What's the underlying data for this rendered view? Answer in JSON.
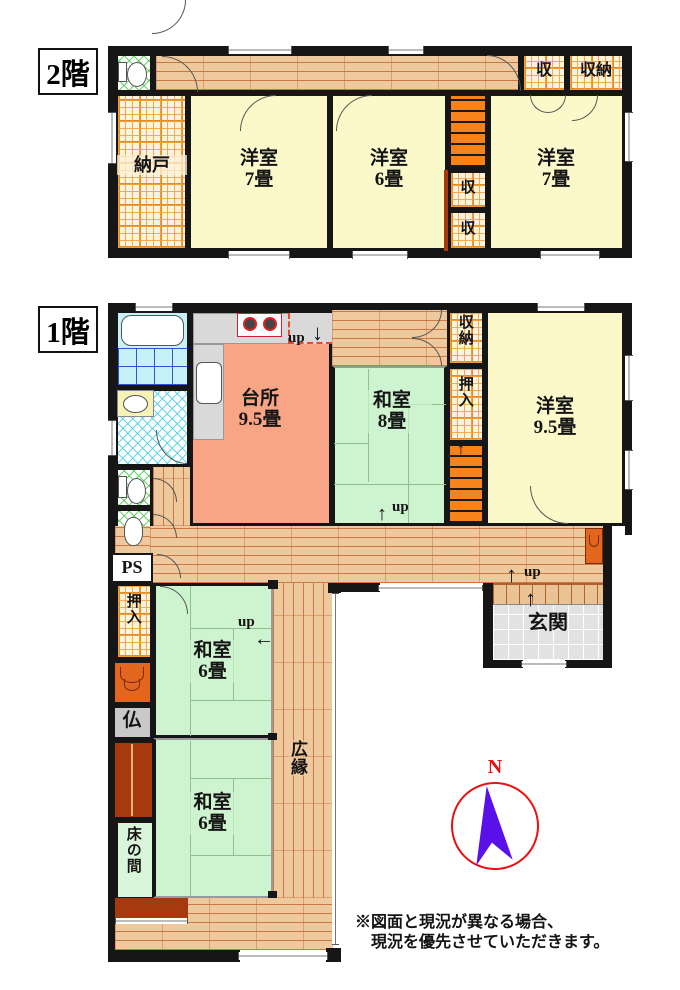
{
  "floor2": {
    "label": "2階",
    "nando": "納戸",
    "yoshitsu7a": {
      "name": "洋室",
      "size": "7畳"
    },
    "yoshitsu6": {
      "name": "洋室",
      "size": "6畳"
    },
    "yoshitsu7b": {
      "name": "洋室",
      "size": "7畳"
    },
    "closet_top1": "収",
    "closet_top2": "収納",
    "closet_mid1": "収",
    "closet_mid2": "収"
  },
  "floor1": {
    "label": "1階",
    "daidokoro": {
      "name": "台所",
      "size": "9.5畳"
    },
    "washitsu8": {
      "name": "和室",
      "size": "8畳"
    },
    "yoshitsu95": {
      "name": "洋室",
      "size": "9.5畳"
    },
    "shunou": "収納",
    "oshiire_right": "押入",
    "oshiire_left": "押入",
    "ps": "PS",
    "butsuma": "仏",
    "washitsu6a": {
      "name": "和室",
      "size": "6畳"
    },
    "washitsu6b": {
      "name": "和室",
      "size": "6畳"
    },
    "tokonoma": "床の間",
    "hiroen": "広縁",
    "genkan": "玄関",
    "up": "up"
  },
  "icons": {
    "arrow_up": "↑",
    "arrow_down": "↓",
    "arrow_left": "←"
  },
  "compass": {
    "north": "N"
  },
  "note": {
    "line1": "※図面と現況が異なる場合、",
    "line2": "現況を優先させていただきます。"
  },
  "colors": {
    "wall": "#161616",
    "tatami": "#cdf3cf",
    "western_room": "#fbf9c9",
    "kitchen": "#f7a584",
    "wood_floor": "#edc99d",
    "closet_plaid": "#fdf3da",
    "stairs": "#f6831c",
    "dark_cabinet": "#a63a0e",
    "compass_ring": "#e81010",
    "compass_needle": "#5a10e8"
  }
}
